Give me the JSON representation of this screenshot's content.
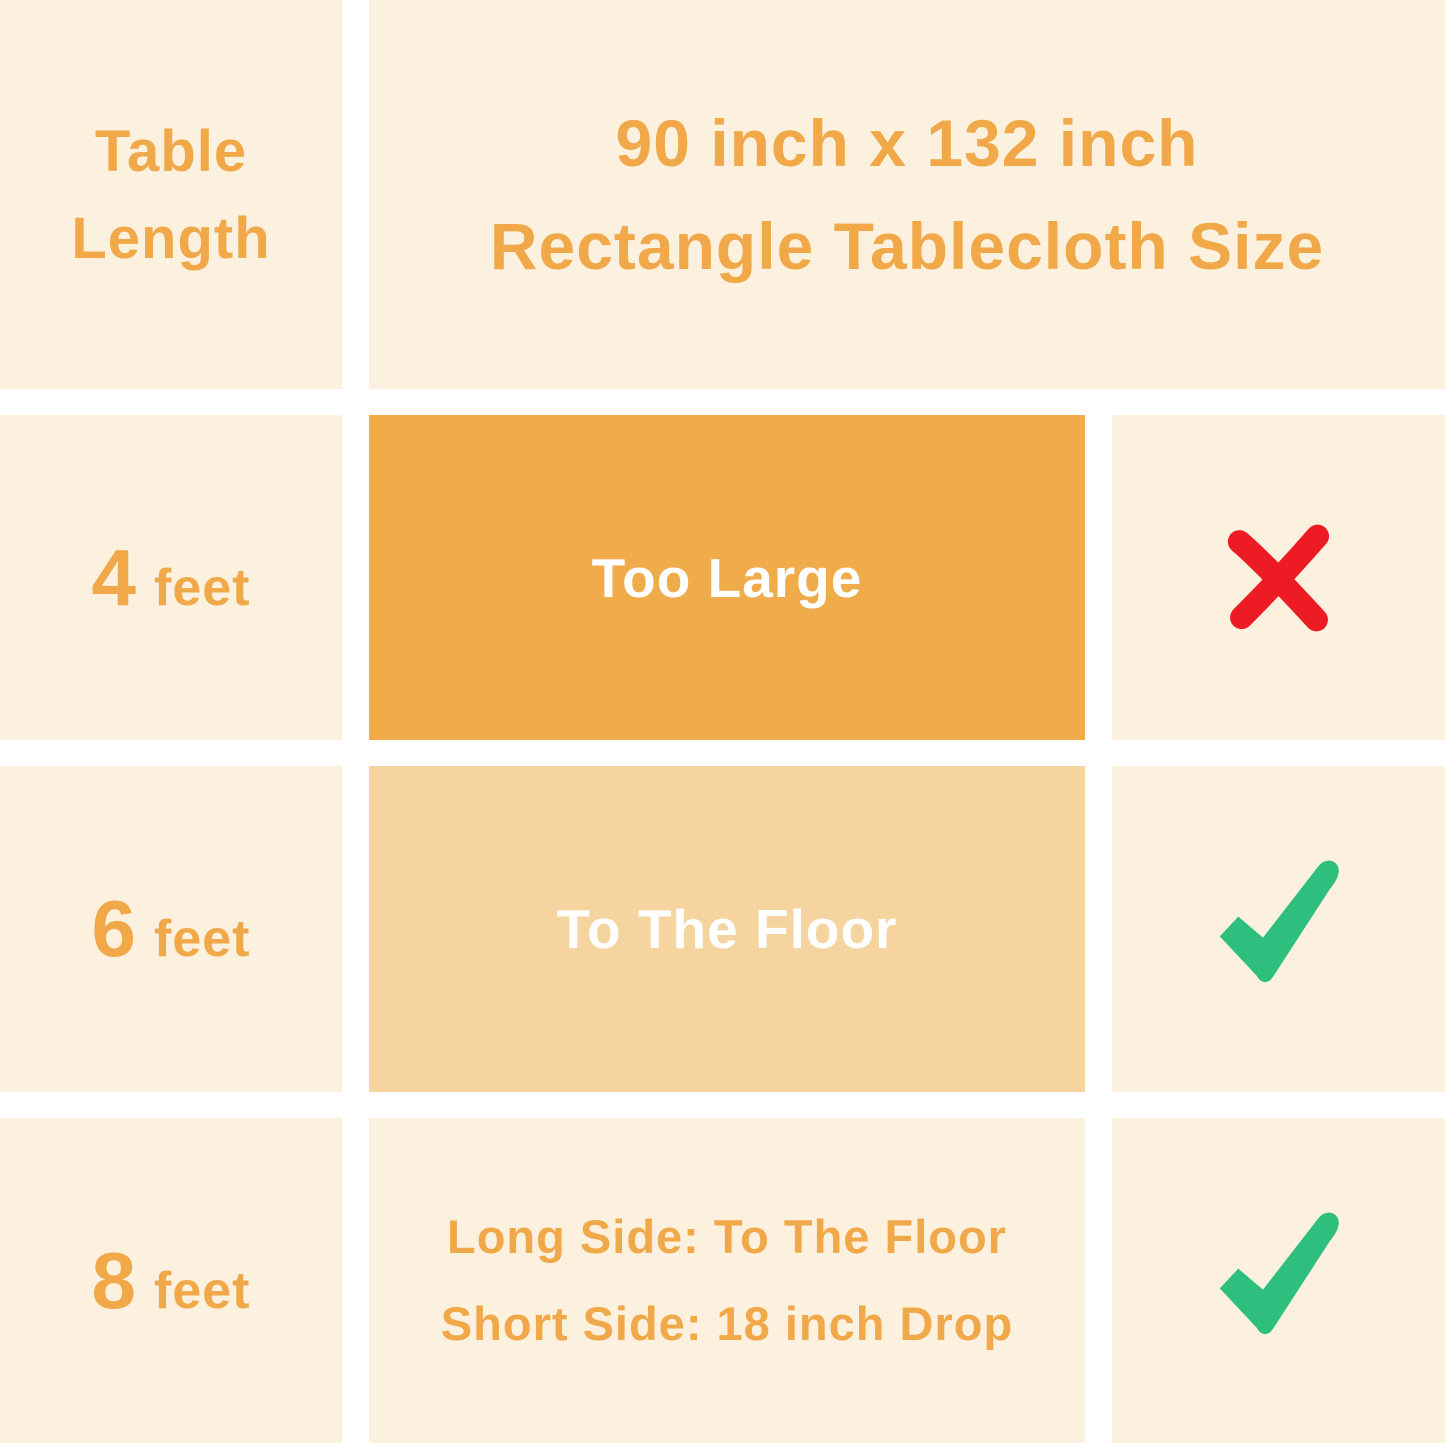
{
  "palette": {
    "cream": "#fcf1de",
    "white_gap": "#ffffff",
    "orange_text": "#f0a848",
    "box_dark": "#f0ac4b",
    "box_light": "#f5d49f",
    "white_text": "#ffffff",
    "cross_red": "#ed1c24",
    "check_green": "#2ebe7d"
  },
  "header": {
    "table_length_line1": "Table",
    "table_length_line2": "Length",
    "title_line1": "90 inch x 132 inch",
    "title_line2": "Rectangle Tablecloth Size"
  },
  "rows": [
    {
      "length_value": "4",
      "length_unit": "feet",
      "fit_label": "Too Large",
      "verdict": "cross"
    },
    {
      "length_value": "6",
      "length_unit": "feet",
      "fit_label": "To The Floor",
      "verdict": "check"
    },
    {
      "length_value": "8",
      "length_unit": "feet",
      "fit_line1": "Long Side: To The Floor",
      "fit_line2": "Short Side: 18 inch Drop",
      "verdict": "check"
    }
  ],
  "icons": {
    "cross": "red-x-icon",
    "check": "green-check-icon"
  },
  "chart_data": {
    "type": "table",
    "title": "90 inch x 132 inch Rectangle Tablecloth Size",
    "columns": [
      "Table Length",
      "90 inch x 132 inch Rectangle Tablecloth Size",
      "Fit Verdict"
    ],
    "rows": [
      [
        "4 feet",
        "Too Large",
        "no"
      ],
      [
        "6 feet",
        "To The Floor",
        "yes"
      ],
      [
        "8 feet",
        "Long Side: To The Floor; Short Side: 18 inch Drop",
        "yes"
      ]
    ],
    "layout_hints": {
      "header_spans_columns_2_and_3": true,
      "row1_middle_cell": "solid dark orange box, white text",
      "row2_middle_cell": "solid light orange box, white text",
      "row3_middle_cell": "cream background, orange two-line text",
      "grid_gaps": "white separators ~27px"
    }
  }
}
